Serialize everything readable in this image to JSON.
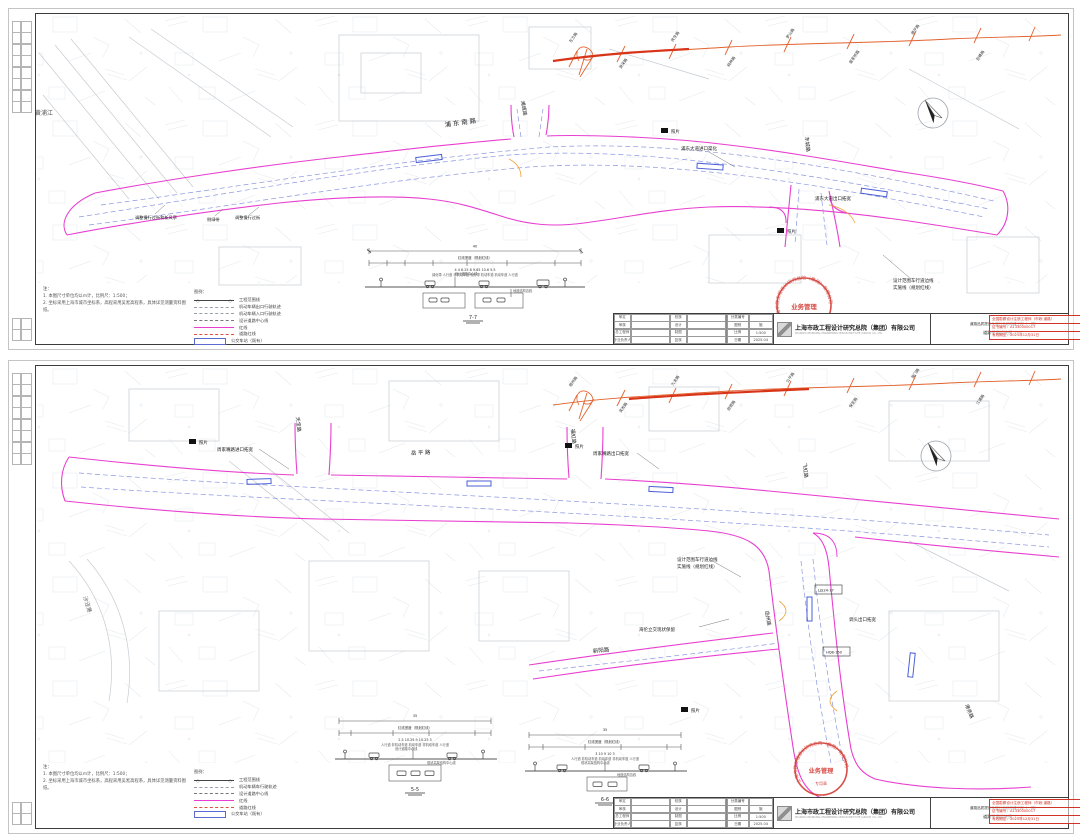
{
  "colors": {
    "magenta": "#e83fd0",
    "orange": "#e2622e",
    "highlight_red": "#d83418",
    "stamp_red": "#d03028",
    "blue": "#8a97e0",
    "gray_line": "#c6ccd2"
  },
  "doc": {
    "company": "上海市政工程设计研究总院（集团）有限公司",
    "company_en": "SHANGHAI MUNICIPAL ENGINEERING DESIGN INSTITUTE (GROUP) CO., LTD.",
    "stamp": {
      "ring": "上海市政工程设计研究总院（集团）有限公司",
      "center": "业务管理",
      "sub": "专用章"
    },
    "sig": {
      "l1": "全国勘察设计注册工程师（市政·道路）",
      "l2": "证书编号：A1330000017",
      "l3": "有效期至：2025年12月31日"
    },
    "tb": {
      "sign": [
        "审定",
        "校核",
        "审核",
        "设计",
        "总工程师",
        "制图",
        "专业负责人",
        "复核"
      ],
      "meta": [
        {
          "k": "分类编号",
          "v": ""
        },
        {
          "k": "图别",
          "v": "施"
        },
        {
          "k": "比例",
          "v": "1:500"
        },
        {
          "k": "日期",
          "v": "2025.04"
        }
      ]
    },
    "notes": {
      "t": "注：",
      "n1": "1. 本图尺寸单位均以m计，比例尺：1:500；",
      "n2": "2. 坐标采用上海市城市坐标系，高程采用吴淞高程系，具体详见测量资料图纸。"
    },
    "legend_t": "图例："
  },
  "s1": {
    "project": "道路品质提升及慢行系统改建工程（一期）",
    "title": "道路平面设计图（一）",
    "water": "黄浦江",
    "road_main": "浦东南路",
    "road_c1": "浦城路",
    "road_c2": "东城路",
    "a1": "浦东大道进口渠化",
    "a2": "浦东大道出口拓宽",
    "a3": "设计范围车行道边线",
    "a4": "实施线（规划红线）",
    "a5": "调整慢行过街和新风亭",
    "a6": "侧绿带",
    "a7": "调整慢行过街",
    "photo": "照片",
    "km": [
      "东方路",
      "源深路",
      "民生路",
      "桃林路",
      "罗山路",
      "居家桥路",
      "德平路",
      "巨峰路"
    ],
    "sec": {
      "title": "7-7",
      "tl": "红线宽度（规划红线）",
      "tot": "40",
      "dims": "4    4    6.25    8    9.65    10.6    5.5",
      "labs": "绿化带 人行道 非机动车道 侧分带 机动车道 机动车道 人行道",
      "n1": "设计道路中心线",
      "n2": "地道结构边线"
    },
    "legend": [
      "工程范围线",
      "机动车辆出口行驶轨迹",
      "机动车辆入口行驶轨迹",
      "设计道路中心线",
      "红线",
      "道路红线",
      "公交车站（既有）"
    ]
  },
  "s2": {
    "project": "道路品质提升及慢行系统改建工程（一期）",
    "title": "道路平面设计图（二）",
    "water": "沙泾港",
    "r1": "天宝路",
    "r2": "岳平路",
    "r3": "福虹路",
    "r4": "飞虹路",
    "r5": "岳州路",
    "r6": "新阳路",
    "r7": "港务路",
    "b1": "周家嘴路进口拓宽",
    "b2": "周家嘴路出口拓宽",
    "b3": "设计范围车行道边线",
    "b4": "实施线（规划红线）",
    "b5": "海伦立交现状保留",
    "b6": "调头出口拓宽",
    "box1": "LJS24-17",
    "box2": "HQ8-150",
    "photo": "照片",
    "km": [
      "梧州路",
      "吴淞路",
      "九龙路",
      "旅顺路",
      "公平路",
      "保定路",
      "海门路",
      "江浦路"
    ],
    "sec1": {
      "title": "5-5",
      "tl": "红线宽度（规划红线）",
      "tot": "35",
      "dims": "2.5    10.25    9    10.25    3",
      "labs": "人行道 非机动车道 机动车道 非机动车道 人行道",
      "n1": "设计道路中心线",
      "n2": "现状高架结构中心线"
    },
    "sec2": {
      "title": "6-6",
      "tl": "红线宽度（规划红线）",
      "tot": "35",
      "dims": "3    10    9    10    3",
      "labs": "人行道 非机动车道 机动车道 非机动车道 人行道",
      "n1": "现状高架结构中心线",
      "n2": "地道结构边线"
    },
    "legend": [
      "工程范围线",
      "机动车辆车行驶轨迹",
      "设计道路中心线",
      "红线",
      "道路红线",
      "公交车站（既有）"
    ]
  }
}
